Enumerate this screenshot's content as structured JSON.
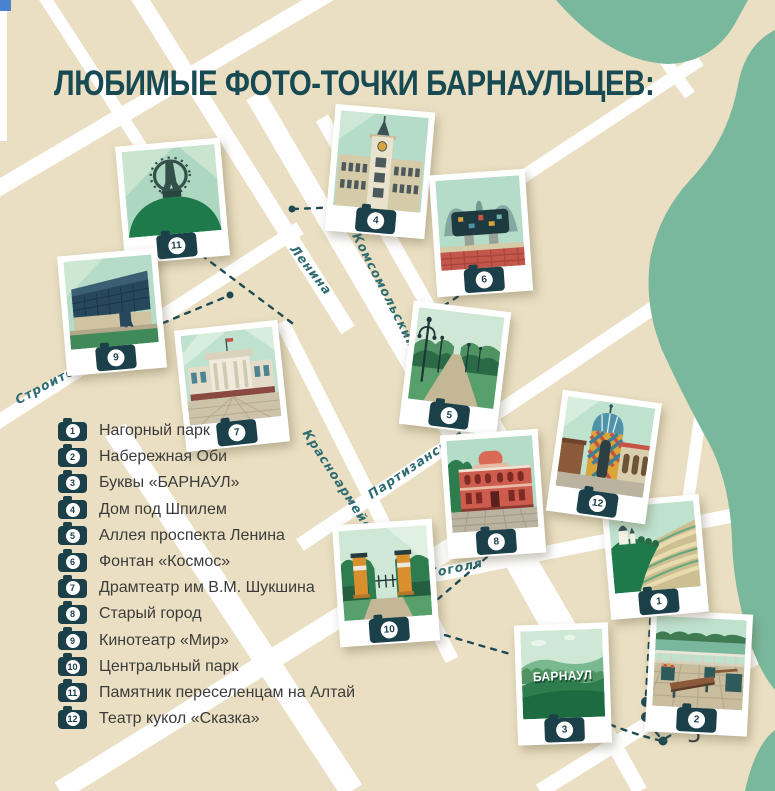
{
  "title": "ЛЮБИМЫЕ ФОТО-ТОЧКИ БАРНАУЛЬЦЕВ:",
  "page_number": "5",
  "barnaul_sign": "БАРНАУЛ",
  "streets": [
    {
      "name": "Ленина"
    },
    {
      "name": "Комсомольский"
    },
    {
      "name": "Красноармейский"
    },
    {
      "name": "Партизанская"
    },
    {
      "name": "Гоголя"
    },
    {
      "name": "Строителей"
    }
  ],
  "legend": [
    {
      "num": "1",
      "label": "Нагорный парк"
    },
    {
      "num": "2",
      "label": "Набережная Оби"
    },
    {
      "num": "3",
      "label": "Буквы «БАРНАУЛ»"
    },
    {
      "num": "4",
      "label": "Дом под Шпилем"
    },
    {
      "num": "5",
      "label": "Аллея проспекта Ленина"
    },
    {
      "num": "6",
      "label": "Фонтан «Космос»"
    },
    {
      "num": "7",
      "label": "Драмтеатр им В.М. Шукшина"
    },
    {
      "num": "8",
      "label": "Старый город"
    },
    {
      "num": "9",
      "label": "Кинотеатр «Мир»"
    },
    {
      "num": "10",
      "label": "Центральный парк"
    },
    {
      "num": "11",
      "label": "Памятник переселенцам на Алтай"
    },
    {
      "num": "12",
      "label": "Театр кукол «Сказка»"
    }
  ],
  "map_photos": [
    {
      "num": "11"
    },
    {
      "num": "4"
    },
    {
      "num": "6"
    },
    {
      "num": "9"
    },
    {
      "num": "7"
    },
    {
      "num": "5"
    },
    {
      "num": "8"
    },
    {
      "num": "12"
    },
    {
      "num": "10"
    },
    {
      "num": "1"
    },
    {
      "num": "3"
    },
    {
      "num": "2"
    }
  ],
  "colors": {
    "map_background": "#eadfc2",
    "street": "#ffffff",
    "river": "#7ab89d",
    "title": "#174a52",
    "street_label": "#2f6b72",
    "legend_text": "#3c3c3c",
    "camera_badge": "#1b4049",
    "route_line": "#1f4a55",
    "polaroid": "#ffffff",
    "corner_square": "#4a82d0"
  }
}
